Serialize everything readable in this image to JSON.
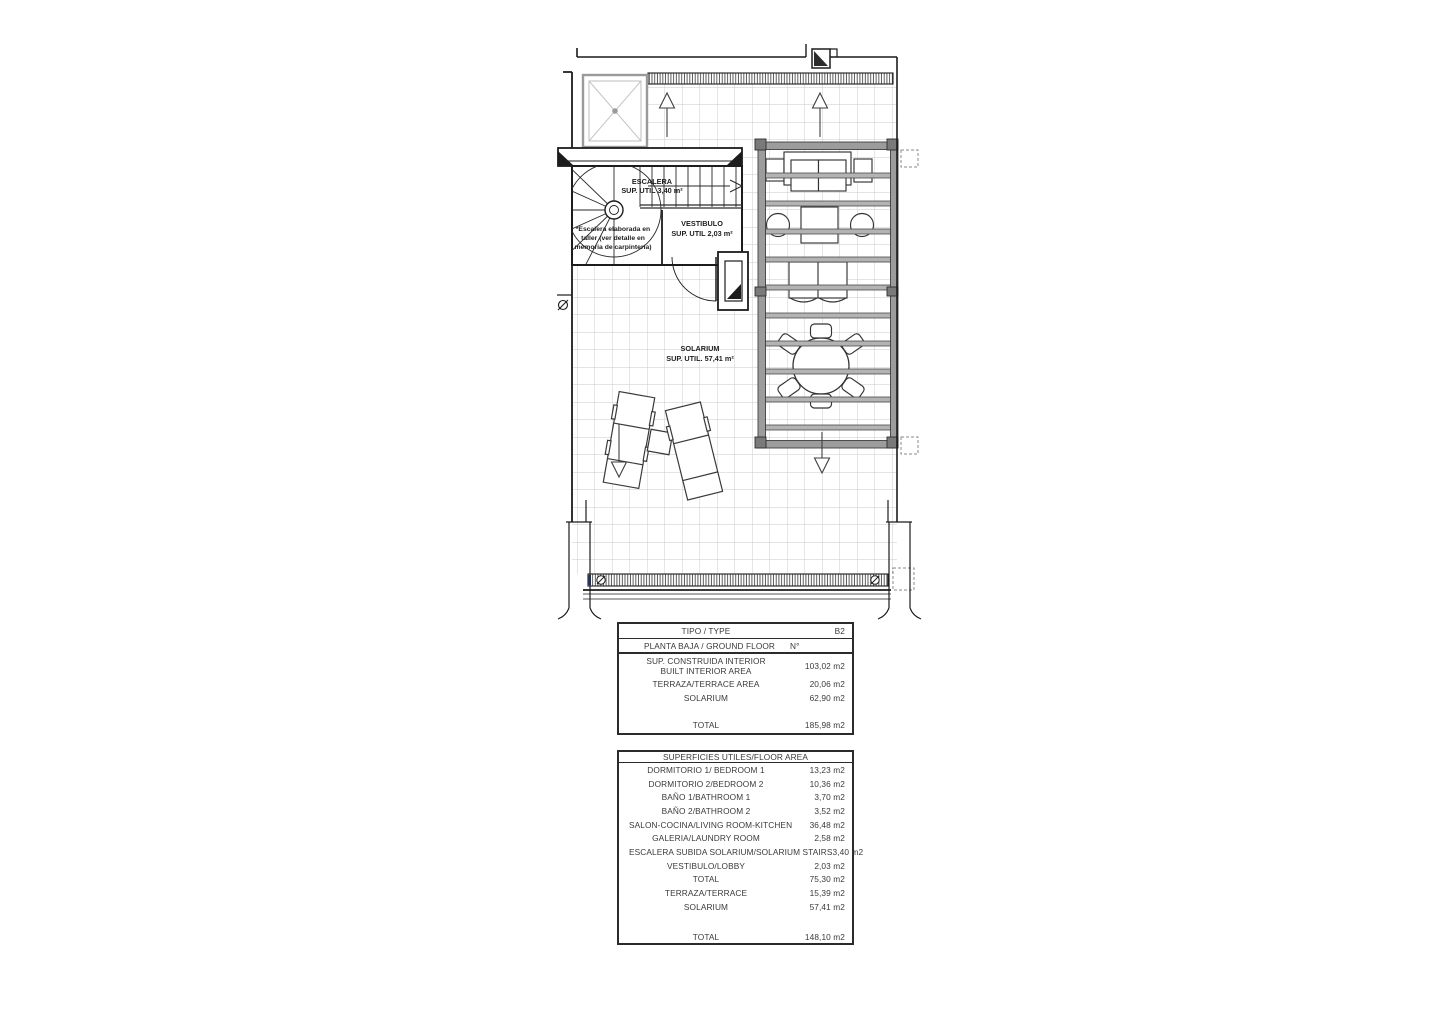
{
  "plan": {
    "escalera": {
      "name": "ESCALERA",
      "area": "SUP. UTIL 3,40 m²"
    },
    "vestibulo": {
      "name": "VESTIBULO",
      "area": "SUP. UTIL 2,03 m²"
    },
    "solarium": {
      "name": "SOLARIUM",
      "area": "SUP. UTIL. 57,41 m²"
    },
    "stair_note": {
      "line1": "*Escalera elaborada en",
      "line2": "taller (ver detalle en",
      "line3": "memoria de carpintería)"
    }
  },
  "tables": {
    "built": {
      "rows": [
        {
          "label": "TIPO / TYPE",
          "value": "B2"
        },
        {
          "label": "PLANTA BAJA / GROUND FLOOR",
          "value": "N°"
        },
        {
          "label": "SUP. CONSTRUIDA INTERIOR",
          "label2": "BUILT INTERIOR AREA",
          "value": "103,02 m2"
        },
        {
          "label": "TERRAZA/TERRACE AREA",
          "value": "20,06 m2"
        },
        {
          "label": "SOLARIUM",
          "value": "62,90 m2"
        },
        {
          "label": "TOTAL",
          "value": "185,98 m2"
        }
      ]
    },
    "useful": {
      "header": "SUPERFICIES UTILES/FLOOR AREA",
      "rows": [
        {
          "label": "DORMITORIO 1/ BEDROOM 1",
          "value": "13,23 m2"
        },
        {
          "label": "DORMITORIO 2/BEDROOM 2",
          "value": "10,36 m2"
        },
        {
          "label": "BAÑO 1/BATHROOM 1",
          "value": "3,70 m2"
        },
        {
          "label": "BAÑO 2/BATHROOM 2",
          "value": "3,52 m2"
        },
        {
          "label": "SALON-COCINA/LIVING ROOM-KITCHEN",
          "value": "36,48 m2"
        },
        {
          "label": "GALERIA/LAUNDRY ROOM",
          "value": "2,58 m2"
        },
        {
          "label": "ESCALERA SUBIDA SOLARIUM/SOLARIUM STAIRS",
          "value": "3,40 m2"
        },
        {
          "label": "VESTIBULO/LOBBY",
          "value": "2,03 m2"
        },
        {
          "label": "TOTAL",
          "value": "75,30 m2"
        },
        {
          "label": "TERRAZA/TERRACE",
          "value": "15,39 m2"
        },
        {
          "label": "SOLARIUM",
          "value": "57,41 m2"
        },
        {
          "label": "TOTAL",
          "value": "148,10 m2"
        }
      ]
    }
  },
  "colors": {
    "wall": "#1c1c1c",
    "tile_line": "#c9c9c9",
    "pergola_frame": "#9c9c9c",
    "pergola_slat": "#b3b3b3",
    "drain_mark_blue": "#3d4f91"
  }
}
